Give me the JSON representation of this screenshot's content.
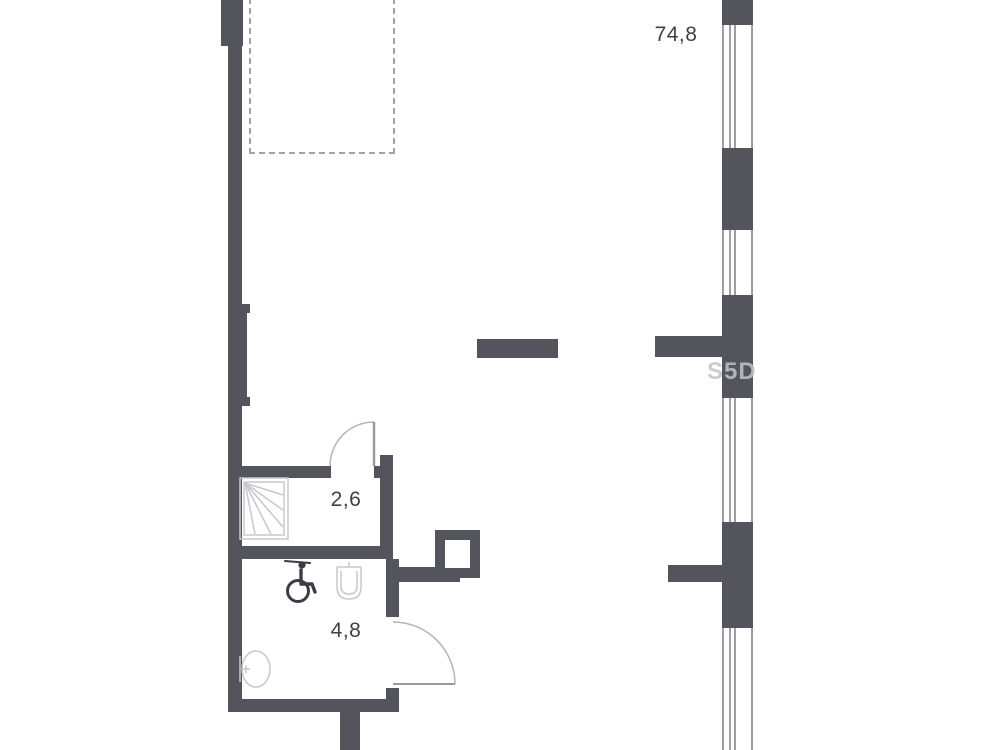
{
  "plan": {
    "type": "apartment-floor-plan",
    "labels": {
      "main_area": "74,8",
      "shower_area": "2,6",
      "bathroom_area": "4,8"
    },
    "watermark": {
      "text": "S5D"
    },
    "icons": [
      {
        "name": "shower-tray-icon"
      },
      {
        "name": "wheelchair-accessible-icon"
      },
      {
        "name": "washbasin-icon"
      },
      {
        "name": "round-basin-toilet-icon"
      },
      {
        "name": "door-swing-arc-shower"
      },
      {
        "name": "door-swing-arc-bathroom"
      }
    ],
    "colors": {
      "wall": "#54545c",
      "window_line": "#9d9da5",
      "dashed": "#a2a2aa",
      "label": "#3f3f49",
      "icon_light": "#c7c7cd",
      "icon_dark": "#3c3c46",
      "watermark": "#c3c3cb",
      "door_arc": "#b4b4ba",
      "door_leaf": "#9a9aa2"
    }
  }
}
